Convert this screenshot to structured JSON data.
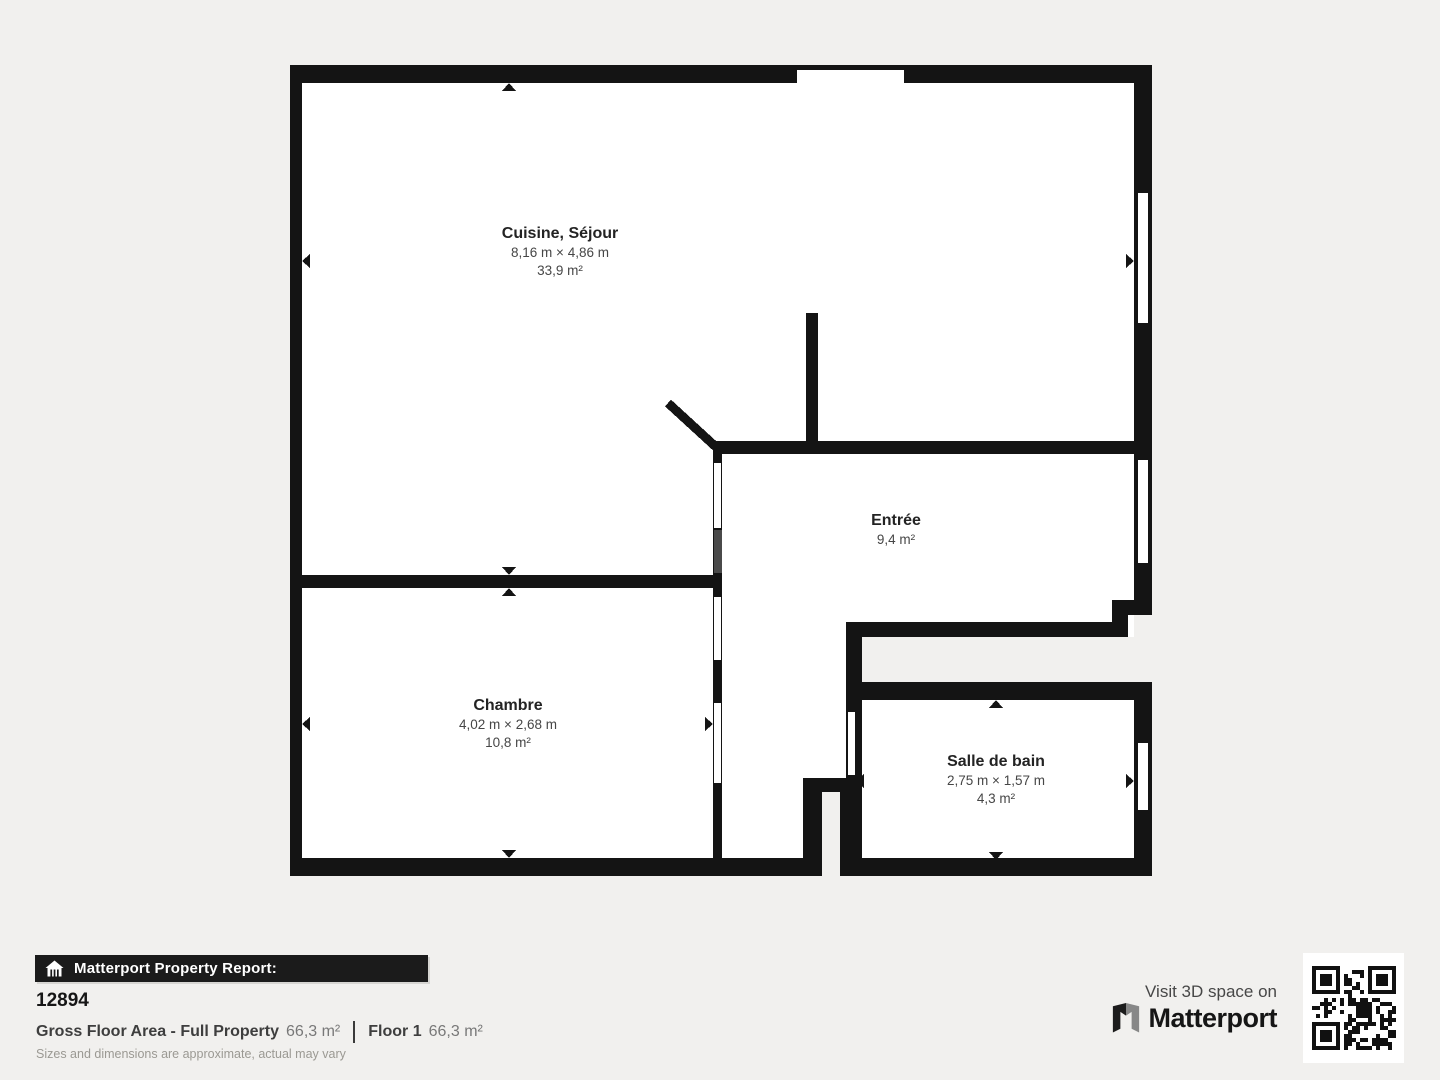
{
  "page": {
    "background": "#f1f0ee",
    "wall_color": "#141414",
    "room_fill": "#ffffff",
    "door_leaf_color": "#4a4a4a"
  },
  "floorplan": {
    "rooms": [
      {
        "name": "Cuisine, Séjour",
        "dimensions": "8,16 m × 4,86 m",
        "area": "33,9 m²"
      },
      {
        "name": "Entrée",
        "dimensions": "",
        "area": "9,4 m²"
      },
      {
        "name": "Chambre",
        "dimensions": "4,02 m × 2,68 m",
        "area": "10,8 m²"
      },
      {
        "name": "Salle de bain",
        "dimensions": "2,75 m × 1,57 m",
        "area": "4,3 m²"
      }
    ]
  },
  "footer": {
    "report_bar_label": "Matterport Property Report:",
    "property_id": "12894",
    "gross_floor_area_label": "Gross Floor Area - Full Property",
    "gross_floor_area_value": "66,3 m²",
    "floor_label": "Floor 1",
    "floor_value": "66,3 m²",
    "disclaimer": "Sizes and dimensions are approximate, actual may vary",
    "visit_text": "Visit 3D space on",
    "brand_name": "Matterport",
    "icons": {
      "report_bar": "house-scan-icon",
      "brand": "matterport-logo-mark",
      "qr": "qr-code"
    }
  }
}
